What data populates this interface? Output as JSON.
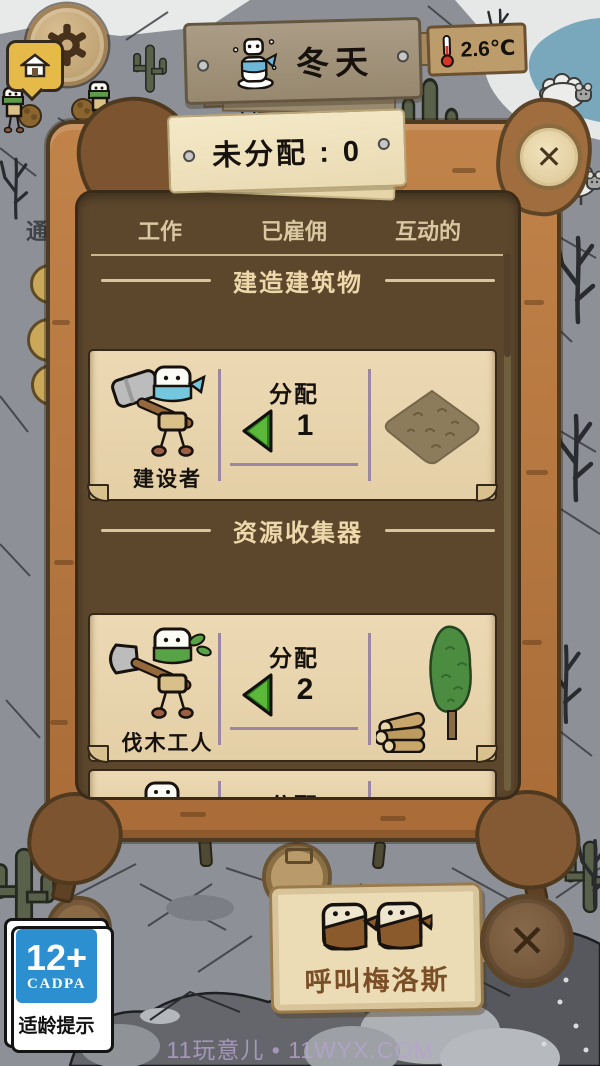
{
  "colors": {
    "frame_wood": "#b97a42",
    "panel_interior": "#5d472c",
    "parchment": "#e9d6b0",
    "arrow_green": "#4ca32e",
    "divider_purple": "#9c87a3",
    "badge_blue": "#2b8fd0"
  },
  "top_bar": {
    "season": {
      "label": "冬天"
    },
    "temperature": {
      "value": "2.6℃"
    },
    "background_sign_text": "通"
  },
  "assign_panel": {
    "header_label": "未分配 : 0",
    "close_glyph": "✕",
    "tabs": [
      {
        "label": "工作"
      },
      {
        "label": "已雇佣"
      },
      {
        "label": "互动的"
      }
    ],
    "sections": [
      {
        "title": "建造建筑物"
      },
      {
        "title": "资源收集器"
      }
    ],
    "workers": [
      {
        "name": "建设者",
        "assign_label": "分配",
        "assigned_count": "1"
      },
      {
        "name": "伐木工人",
        "assign_label": "分配",
        "assigned_count": "2"
      },
      {
        "name": "",
        "assign_label": "分配",
        "assigned_count": ""
      }
    ]
  },
  "bottom_bar": {
    "call_button_label": "呼叫梅洛斯",
    "close_glyph": "✕"
  },
  "rating_badge": {
    "age": "12+",
    "org": "CADPA",
    "caption": "适龄提示"
  },
  "watermark": "11玩意儿 • 11WYX.COM"
}
